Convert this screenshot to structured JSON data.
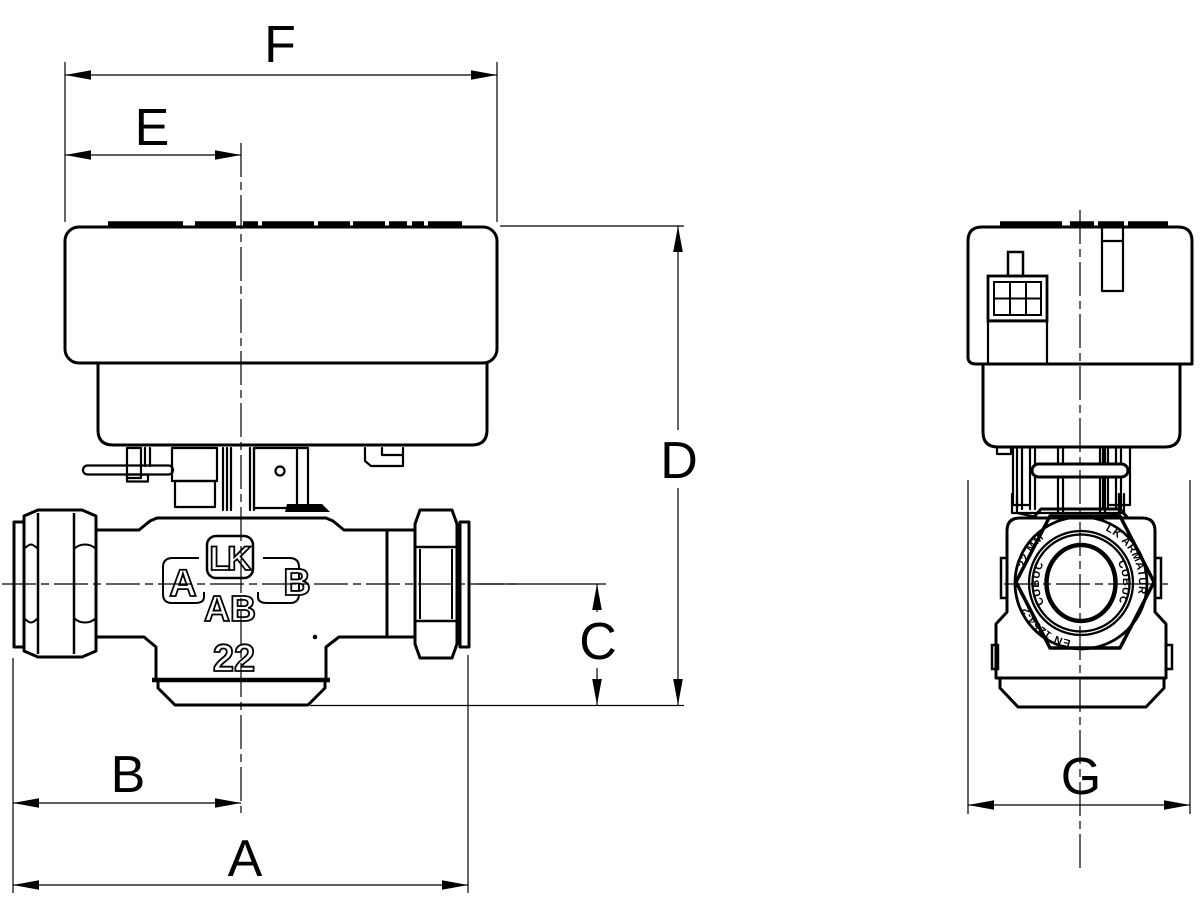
{
  "drawing": {
    "title": "Zone valve with actuator - dimensional drawing",
    "background_color": "#ffffff",
    "line_color": "#000000"
  },
  "dimensions": {
    "f": "F",
    "e": "E",
    "d": "D",
    "c": "C",
    "b": "B",
    "a": "A",
    "g": "G"
  },
  "valve_markings": {
    "logo": "LK",
    "port_left": "A",
    "port_right": "B",
    "port_bottom": "AB",
    "size": "22"
  },
  "nut_markings": {
    "size": "22 MM",
    "brand": "LK ARMATUR",
    "standard": "EN 1254-2",
    "material_left": "CUBUC",
    "material_right": "CUBUC"
  }
}
